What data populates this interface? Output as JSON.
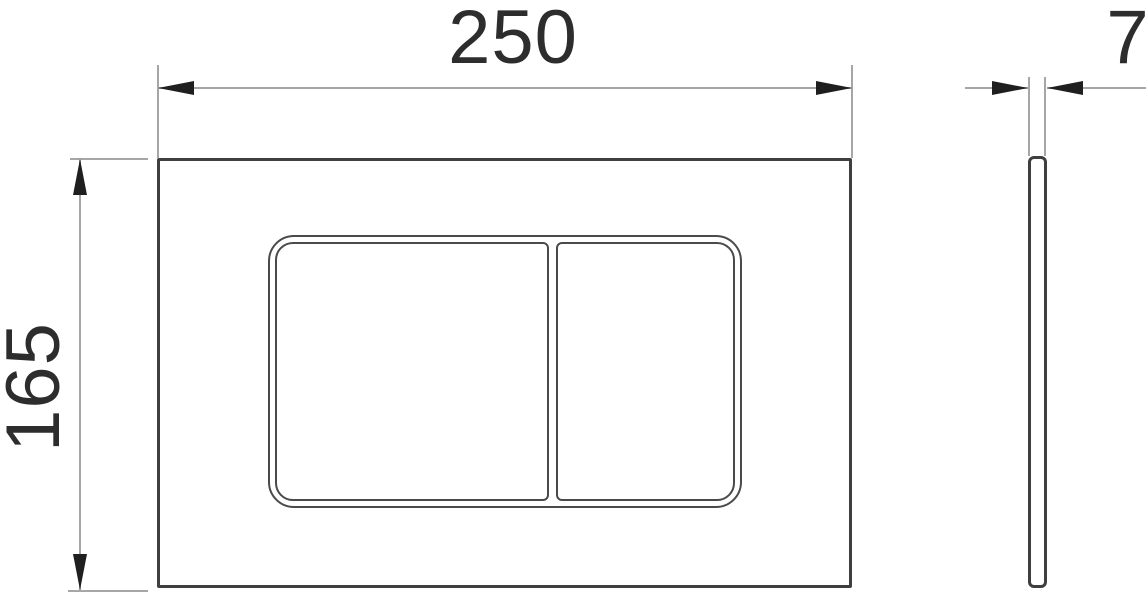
{
  "drawing": {
    "type": "technical-dimension-drawing",
    "views": {
      "front": {
        "width_dimension": "250",
        "height_dimension": "165"
      },
      "side": {
        "thickness_dimension": "7"
      }
    }
  },
  "colors": {
    "background": "#ffffff",
    "plate_outline": "#3f3f3f",
    "button_outline": "#4a4a4a",
    "dimension_line": "#a6a6a6",
    "arrowhead": "#1f1f1f",
    "dimension_text": "#2d2d2d"
  }
}
